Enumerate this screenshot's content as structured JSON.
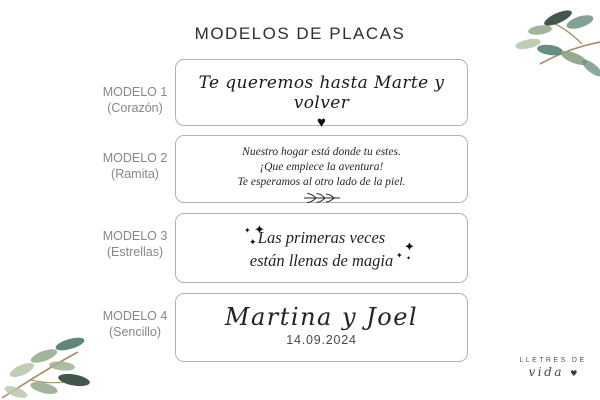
{
  "page": {
    "title": "MODELOS DE PLACAS"
  },
  "models": [
    {
      "label": "MODELO 1",
      "variant": "(Corazón)",
      "line1": "Te queremos hasta Marte y volver",
      "decoration": "heart-icon"
    },
    {
      "label": "MODELO 2",
      "variant": "(Ramita)",
      "line1": "Nuestro hogar está donde tu estes.",
      "line2": "¡Que empiece la aventura!",
      "line3": "Te esperamos al otro lado de la piel.",
      "decoration": "branch-sprig-icon"
    },
    {
      "label": "MODELO 3",
      "variant": "(Estrellas)",
      "line1": "Las primeras veces",
      "line2": "están llenas de magia",
      "decoration": "sparkles-icon"
    },
    {
      "label": "MODELO 4",
      "variant": "(Sencillo)",
      "line1": "Martina y Joel",
      "line2": "14.09.2024",
      "decoration": "none"
    }
  ],
  "brand": {
    "line1": "LLETRES DE",
    "line2": "vida",
    "heart": "♥"
  },
  "icons": {
    "heart": "♥",
    "sparkle": "✦"
  },
  "colors": {
    "box_border": "#b3b3b3",
    "label_grey": "#878787",
    "title_dark": "#2e2e2e",
    "ink_black": "#1a1a1a",
    "brand_green": "#3c4a42",
    "leaf_dark": "#2e4438",
    "leaf_teal": "#4e7a6d",
    "leaf_sage": "#8ba183",
    "leaf_light": "#b8c8ad",
    "stem_brown": "#a98a63"
  }
}
